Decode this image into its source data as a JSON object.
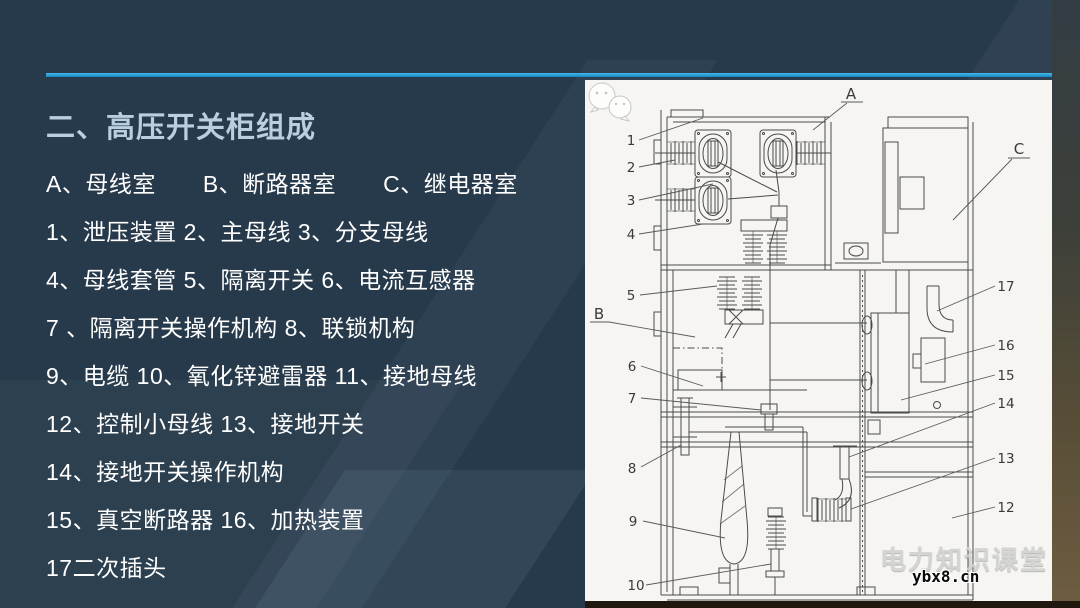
{
  "slide": {
    "title": "二、高压开关柜组成",
    "legend_lines": [
      "A、母线室　　B、断路器室　　C、继电器室",
      "1、泄压装置 2、主母线 3、分支母线",
      "4、母线套管 5、隔离开关 6、电流互感器",
      "7 、隔离开关操作机构 8、联锁机构",
      "9、电缆 10、氧化锌避雷器 11、接地母线",
      "12、控制小母线 13、接地开关",
      "14、接地开关操作机构",
      "15、真空断路器 16、加热装置",
      "17二次插头"
    ]
  },
  "diagram": {
    "labels": {
      "A": "A",
      "B": "B",
      "C": "C",
      "1": "1",
      "2": "2",
      "3": "3",
      "4": "4",
      "5": "5",
      "6": "6",
      "7": "7",
      "8": "8",
      "9": "9",
      "10": "10",
      "12": "12",
      "13": "13",
      "14": "14",
      "15": "15",
      "16": "16",
      "17": "17"
    }
  },
  "watermark": {
    "brand": "电力知识课堂",
    "site": "ybx8.cn"
  },
  "colors": {
    "background": "#273a4b",
    "accent_line": "#2aa3dc",
    "title_text": "#b9cede",
    "body_text": "#ffffff",
    "panel_bg": "#f6f5f1",
    "diagram_stroke": "#4a4a4a",
    "photo_edge_top": "#333d44",
    "photo_edge_bottom": "#6e5d41",
    "watermark_brand": "#d0d0d0",
    "watermark_site": "#0a0a0a"
  }
}
